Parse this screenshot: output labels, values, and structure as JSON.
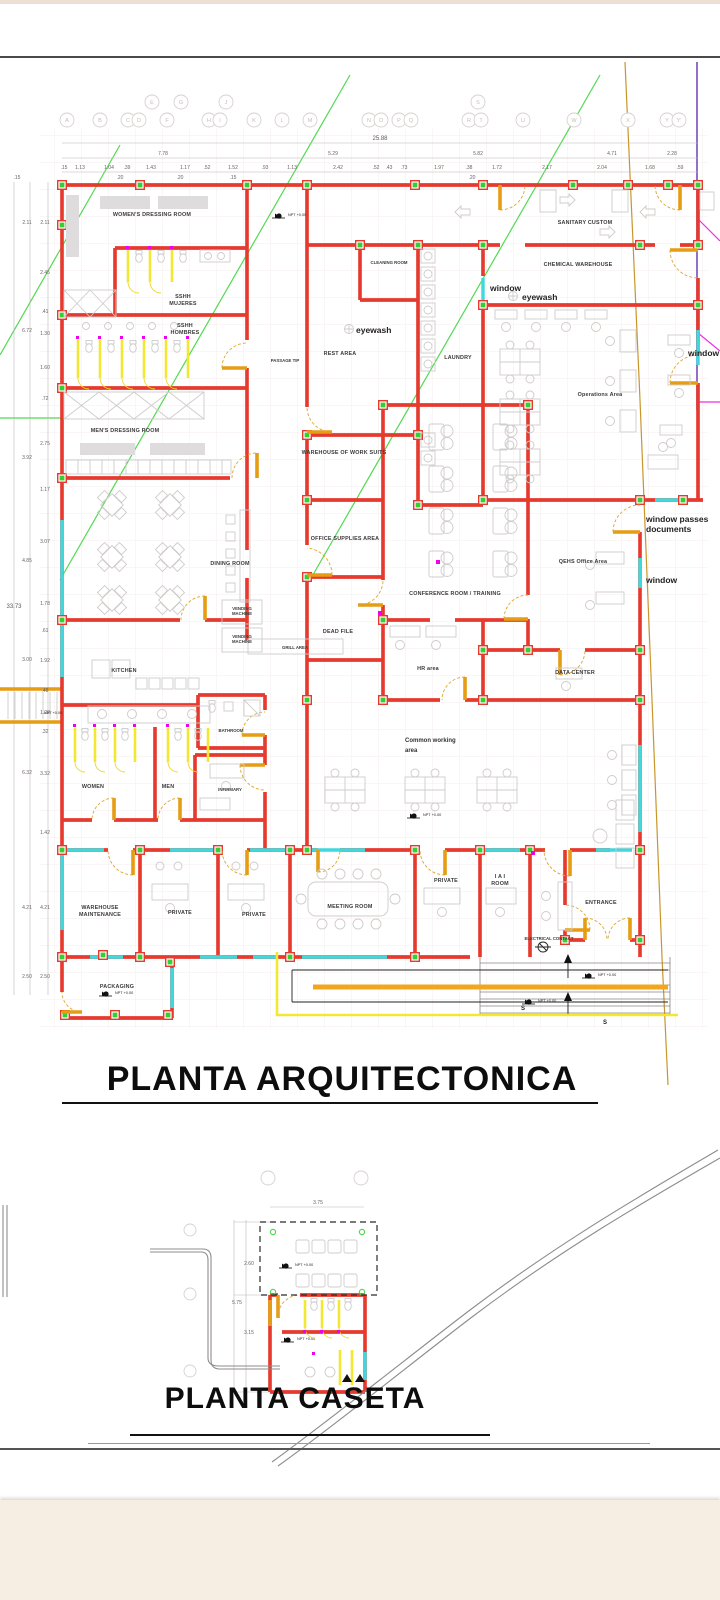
{
  "page": {
    "title_main": "PLANTA ARQUITECTONICA",
    "title_caseta": "PLANTA CASETA"
  },
  "grid": {
    "top_row": [
      "A",
      "B",
      "C",
      "D",
      "F",
      "H",
      "I",
      "K",
      "L",
      "M",
      "N",
      "O",
      "P",
      "Q",
      "R",
      "T",
      "U",
      "W",
      "X",
      "Y",
      "Y'"
    ],
    "upper_row": [
      "E",
      "G",
      "J",
      "S"
    ]
  },
  "dims": {
    "top_total": "25.88",
    "top_row2": [
      "7.78",
      "5.29",
      "5.82",
      "4.71",
      "2.28"
    ],
    "top_row3": [
      ".15",
      "1.13",
      "1.04",
      ".39",
      "1.43",
      "1.17",
      ".52",
      "1.52",
      ".93",
      "1.13",
      "2.42",
      ".52",
      ".43",
      ".73",
      "1.97",
      ".38",
      "1.72",
      "2.17",
      "2.04",
      "1.68",
      ".59"
    ],
    "top_row4": [
      ".20",
      ".20",
      ".15",
      ".20"
    ],
    "left_total": "33.73",
    "left_mid": [
      "2.11",
      "6.72",
      "3.92",
      "4.85",
      "3.00",
      "6.32",
      "4.21",
      "2.50"
    ],
    "left_fine": [
      ".15",
      "2.11",
      "2.45",
      ".41",
      "1.30",
      "1.60",
      ".72",
      "2.75",
      "1.17",
      "3.07",
      "1.78",
      ".61",
      "1.92",
      ".48",
      "1.29",
      ".32",
      "3.32",
      "1.42",
      "4.21",
      "2.50"
    ],
    "caseta": [
      "3.75",
      "2.60",
      "5.75",
      "3.15"
    ]
  },
  "rooms": {
    "womens_dressing": "WOMEN'S DRESSING ROOM",
    "sshh": "SSHH",
    "mujeres": "MUJERES",
    "hombres": "HOMBRES",
    "mens_dressing": "MEN'S DRESSING ROOM",
    "passage": "PASSAGE TIP",
    "cleaning": "CLEANING ROOM",
    "rest_area": "REST AREA",
    "laundry": "LAUNDRY",
    "sanitary": "SANITARY CUSTOM",
    "chemical": "CHEMICAL WAREHOUSE",
    "operations": "Operations Area",
    "warehouse_suits": "WAREHOUSE OF WORK SUITS",
    "office_supplies": "OFFICE SUPPLIES AREA",
    "conference": "CONFERENCE ROOM / TRAINING",
    "dead_file": "DEAD FILE",
    "hr": "HR area",
    "qehs": "QEHS Office Area",
    "data_center": "DATA CENTER",
    "dining": "DINING ROOM",
    "kitchen": "KITCHEN",
    "grill": "GRILL AREA",
    "vending1": "VENDING",
    "vending2": "MACHINE",
    "bathroom": "BATHROOM",
    "infirmary": "INFIRMARY",
    "women": "WOMEN",
    "men": "MEN",
    "common1": "Common working",
    "common2": "area",
    "warehouse_maint1": "WAREHOUSE",
    "warehouse_maint2": "MAINTENANCE",
    "private": "PRIVATE",
    "meeting": "MEETING ROOM",
    "iai1": "I A I",
    "iai2": "ROOM",
    "entrance": "ENTRANCE",
    "electrical": "ELECTRICAL CONTACT",
    "packaging": "PACKAGING"
  },
  "annotations": {
    "window": "window",
    "window_passes1": "window passes",
    "window_passes2": "documents",
    "eyewash": "eyewash",
    "npt": "NPT +0.00",
    "s": "S"
  }
}
